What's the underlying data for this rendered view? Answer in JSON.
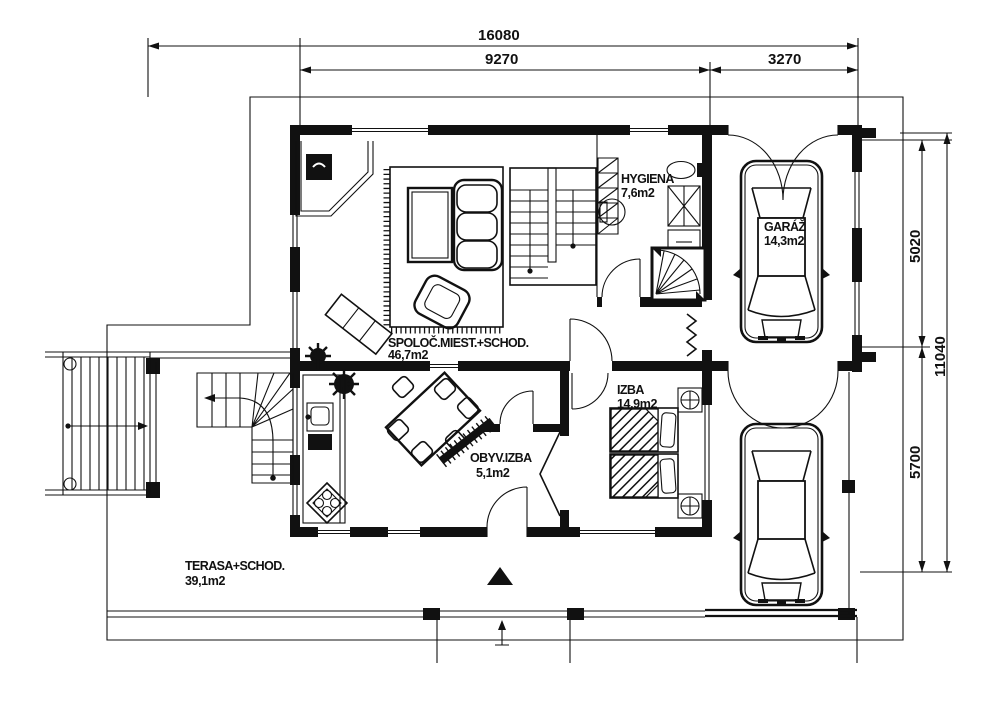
{
  "plan": {
    "title": "floor-plan-ground",
    "ink_color": "#111111",
    "paper_color": "#ffffff"
  },
  "dimensions": {
    "top_total": "16080",
    "top_main": "9270",
    "top_garage": "3270",
    "right_upper": "5020",
    "right_total": "11040",
    "right_lower": "5700"
  },
  "rooms": {
    "living": {
      "name": "SPOLOČ.MIEST.+SCHOD.",
      "area": "46,7m2"
    },
    "hygiene": {
      "name": "HYGIENA",
      "area": "7,6m2"
    },
    "garage": {
      "name": "GARÁŽ",
      "area": "14,3m2"
    },
    "bedroom": {
      "name": "IZBA",
      "area": "14,9m2"
    },
    "vestibule": {
      "name": "OBYV.IZBA",
      "area": "5,1m2"
    },
    "terrace": {
      "name": "TERASA+SCHOD.",
      "area": "39,1m2"
    }
  }
}
